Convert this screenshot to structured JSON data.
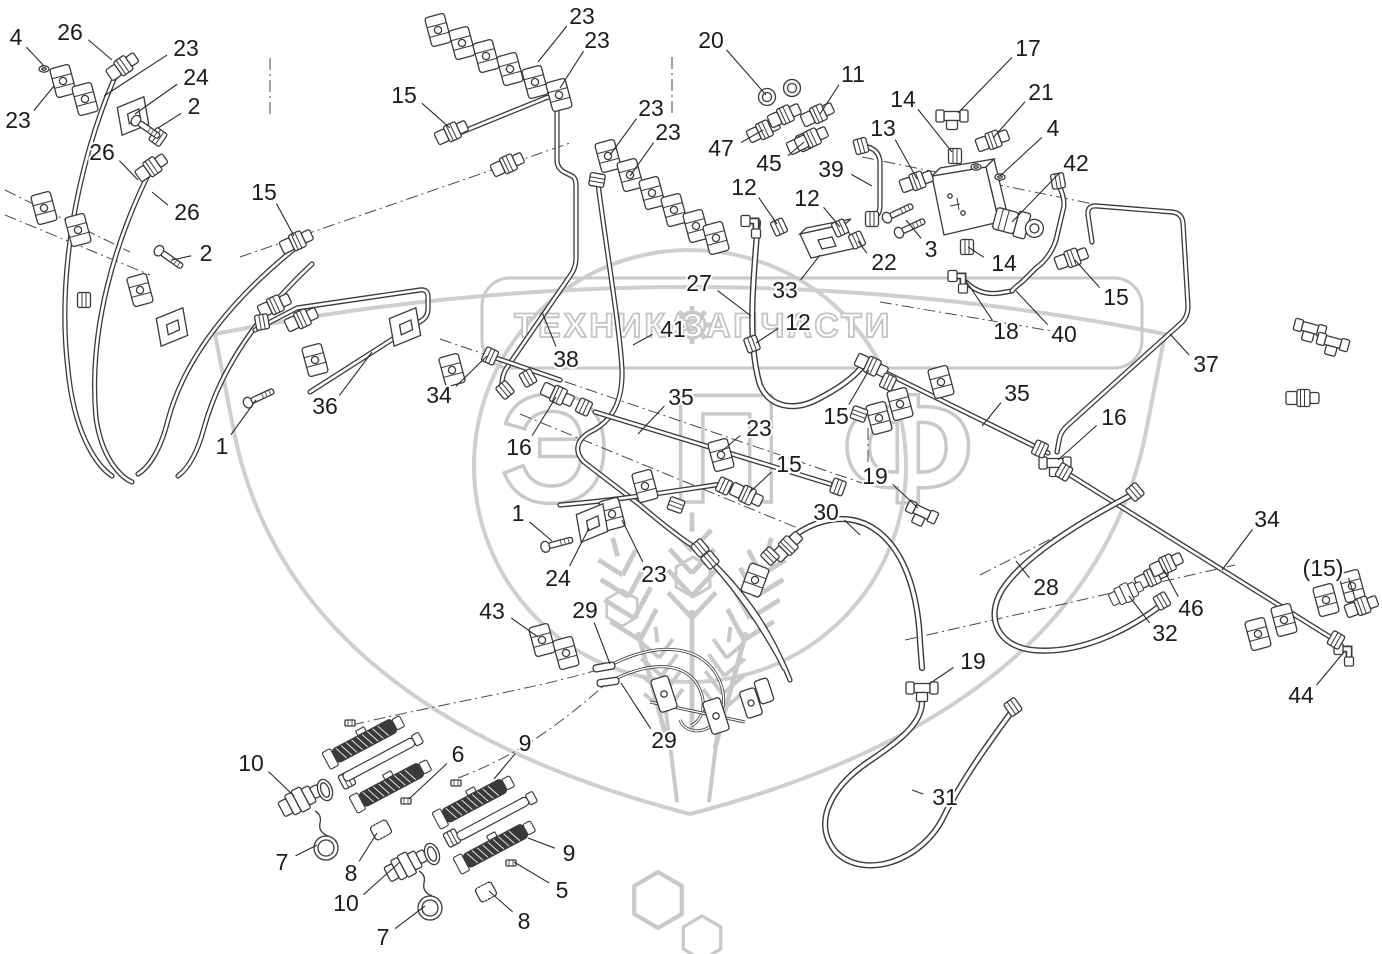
{
  "page": {
    "width": 1382,
    "height": 954,
    "background": "#ffffff"
  },
  "colors": {
    "line": "#3a3a3a",
    "label": "#1c1c1c",
    "leader": "#2b2b2b",
    "watermark": "#c9c9c9"
  },
  "watermark": {
    "banner_left": "ТЕХНИКА",
    "banner_right": "ЗАПЧАСТИ",
    "monogram": "ЭПФ",
    "gear_icon": "gear-icon"
  },
  "diagram": {
    "type": "exploded-parts-diagram",
    "subject": "hydraulic pipes, hoses, fittings and clamps",
    "callouts": [
      {
        "label": "4",
        "x": 16,
        "y": 37,
        "tx": 44,
        "ty": 66
      },
      {
        "label": "26",
        "x": 70,
        "y": 32,
        "tx": 112,
        "ty": 60
      },
      {
        "label": "23",
        "x": 186,
        "y": 48,
        "tx": 104,
        "ty": 96
      },
      {
        "label": "24",
        "x": 196,
        "y": 77,
        "tx": 135,
        "ty": 114
      },
      {
        "label": "2",
        "x": 194,
        "y": 106,
        "tx": 158,
        "ty": 128
      },
      {
        "label": "23",
        "x": 18,
        "y": 120,
        "tx": 54,
        "ty": 86
      },
      {
        "label": "26",
        "x": 102,
        "y": 152,
        "tx": 138,
        "ty": 180
      },
      {
        "label": "26",
        "x": 187,
        "y": 212,
        "tx": 152,
        "ty": 192
      },
      {
        "label": "2",
        "x": 206,
        "y": 253,
        "tx": 172,
        "ty": 260
      },
      {
        "label": "15",
        "x": 404,
        "y": 95,
        "tx": 450,
        "ty": 128
      },
      {
        "label": "15",
        "x": 264,
        "y": 192,
        "tx": 294,
        "ty": 236
      },
      {
        "label": "23",
        "x": 582,
        "y": 16,
        "tx": 538,
        "ty": 62
      },
      {
        "label": "23",
        "x": 597,
        "y": 40,
        "tx": 560,
        "ty": 88
      },
      {
        "label": "23",
        "x": 651,
        "y": 108,
        "tx": 610,
        "ty": 155
      },
      {
        "label": "23",
        "x": 668,
        "y": 132,
        "tx": 630,
        "ty": 176
      },
      {
        "label": "20",
        "x": 711,
        "y": 40,
        "tx": 766,
        "ty": 95
      },
      {
        "label": "11",
        "x": 853,
        "y": 74,
        "tx": 820,
        "ty": 114
      },
      {
        "label": "47",
        "x": 721,
        "y": 148,
        "tx": 763,
        "ty": 130
      },
      {
        "label": "45",
        "x": 769,
        "y": 163,
        "tx": 804,
        "ty": 142
      },
      {
        "label": "17",
        "x": 1028,
        "y": 48,
        "tx": 958,
        "ty": 113
      },
      {
        "label": "14",
        "x": 903,
        "y": 99,
        "tx": 952,
        "ty": 152
      },
      {
        "label": "21",
        "x": 1041,
        "y": 92,
        "tx": 993,
        "ty": 138
      },
      {
        "label": "13",
        "x": 883,
        "y": 128,
        "tx": 917,
        "ty": 179
      },
      {
        "label": "4",
        "x": 1053,
        "y": 128,
        "tx": 1000,
        "ty": 176
      },
      {
        "label": "42",
        "x": 1076,
        "y": 163,
        "tx": 1012,
        "ty": 222
      },
      {
        "label": "39",
        "x": 831,
        "y": 169,
        "tx": 872,
        "ty": 186
      },
      {
        "label": "12",
        "x": 744,
        "y": 187,
        "tx": 777,
        "ty": 224
      },
      {
        "label": "12",
        "x": 807,
        "y": 198,
        "tx": 840,
        "ty": 227
      },
      {
        "label": "22",
        "x": 884,
        "y": 262,
        "tx": 858,
        "ty": 241
      },
      {
        "label": "33",
        "x": 785,
        "y": 290,
        "tx": 820,
        "ty": 255
      },
      {
        "label": "3",
        "x": 931,
        "y": 249,
        "tx": 906,
        "ty": 220
      },
      {
        "label": "14",
        "x": 1004,
        "y": 263,
        "tx": 968,
        "ty": 247
      },
      {
        "label": "18",
        "x": 1006,
        "y": 331,
        "tx": 966,
        "ty": 281
      },
      {
        "label": "40",
        "x": 1064,
        "y": 334,
        "tx": 1016,
        "ty": 291
      },
      {
        "label": "15",
        "x": 1116,
        "y": 297,
        "tx": 1075,
        "ty": 260
      },
      {
        "label": "37",
        "x": 1206,
        "y": 364,
        "tx": 1170,
        "ty": 334
      },
      {
        "label": "27",
        "x": 699,
        "y": 283,
        "tx": 751,
        "ty": 316
      },
      {
        "label": "41",
        "x": 673,
        "y": 329,
        "tx": 633,
        "ty": 345
      },
      {
        "label": "38",
        "x": 566,
        "y": 359,
        "tx": 542,
        "ty": 312
      },
      {
        "label": "35",
        "x": 681,
        "y": 397,
        "tx": 638,
        "ty": 434
      },
      {
        "label": "16",
        "x": 519,
        "y": 447,
        "tx": 556,
        "ty": 397
      },
      {
        "label": "23",
        "x": 759,
        "y": 428,
        "tx": 722,
        "ty": 451
      },
      {
        "label": "15",
        "x": 836,
        "y": 416,
        "tx": 869,
        "ty": 370
      },
      {
        "label": "15",
        "x": 789,
        "y": 464,
        "tx": 749,
        "ty": 493
      },
      {
        "label": "19",
        "x": 875,
        "y": 476,
        "tx": 918,
        "ty": 508
      },
      {
        "label": "30",
        "x": 826,
        "y": 512,
        "tx": 860,
        "ty": 535
      },
      {
        "label": "1",
        "x": 518,
        "y": 513,
        "tx": 552,
        "ty": 541
      },
      {
        "label": "24",
        "x": 558,
        "y": 578,
        "tx": 589,
        "ty": 528
      },
      {
        "label": "23",
        "x": 654,
        "y": 574,
        "tx": 622,
        "ty": 520
      },
      {
        "label": "43",
        "x": 492,
        "y": 611,
        "tx": 538,
        "ty": 637
      },
      {
        "label": "29",
        "x": 585,
        "y": 610,
        "tx": 610,
        "ty": 664
      },
      {
        "label": "10",
        "x": 251,
        "y": 763,
        "tx": 294,
        "ty": 796
      },
      {
        "label": "6",
        "x": 458,
        "y": 754,
        "tx": 409,
        "ty": 799
      },
      {
        "label": "9",
        "x": 525,
        "y": 743,
        "tx": 494,
        "ty": 779
      },
      {
        "label": "7",
        "x": 282,
        "y": 862,
        "tx": 317,
        "ty": 845
      },
      {
        "label": "8",
        "x": 351,
        "y": 873,
        "tx": 377,
        "ty": 833
      },
      {
        "label": "10",
        "x": 346,
        "y": 903,
        "tx": 400,
        "ty": 862
      },
      {
        "label": "9",
        "x": 569,
        "y": 853,
        "tx": 528,
        "ty": 838
      },
      {
        "label": "5",
        "x": 562,
        "y": 890,
        "tx": 514,
        "ty": 862
      },
      {
        "label": "8",
        "x": 524,
        "y": 921,
        "tx": 489,
        "ty": 891
      },
      {
        "label": "7",
        "x": 383,
        "y": 937,
        "tx": 425,
        "ty": 906
      },
      {
        "label": "19",
        "x": 973,
        "y": 661,
        "tx": 929,
        "ty": 684
      },
      {
        "label": "31",
        "x": 945,
        "y": 797,
        "tx": 912,
        "ty": 790
      },
      {
        "label": "29",
        "x": 664,
        "y": 740,
        "tx": 621,
        "ty": 683
      },
      {
        "label": "28",
        "x": 1046,
        "y": 587,
        "tx": 1016,
        "ty": 561
      },
      {
        "label": "46",
        "x": 1191,
        "y": 608,
        "tx": 1164,
        "ty": 570
      },
      {
        "label": "32",
        "x": 1165,
        "y": 633,
        "tx": 1129,
        "ty": 596
      },
      {
        "label": "34",
        "x": 1267,
        "y": 519,
        "tx": 1222,
        "ty": 570
      },
      {
        "label": "(15)",
        "x": 1323,
        "y": 568,
        "tx": 1356,
        "ty": 601
      },
      {
        "label": "44",
        "x": 1301,
        "y": 695,
        "tx": 1344,
        "ty": 652
      },
      {
        "label": "34",
        "x": 439,
        "y": 395,
        "tx": 487,
        "ty": 356
      },
      {
        "label": "36",
        "x": 325,
        "y": 406,
        "tx": 372,
        "ty": 352
      },
      {
        "label": "1",
        "x": 222,
        "y": 446,
        "tx": 256,
        "ty": 400
      },
      {
        "label": "16",
        "x": 1114,
        "y": 417,
        "tx": 1058,
        "ty": 460
      },
      {
        "label": "35",
        "x": 1017,
        "y": 393,
        "tx": 982,
        "ty": 426
      },
      {
        "label": "12",
        "x": 798,
        "y": 322,
        "tx": 756,
        "ty": 343
      }
    ]
  }
}
